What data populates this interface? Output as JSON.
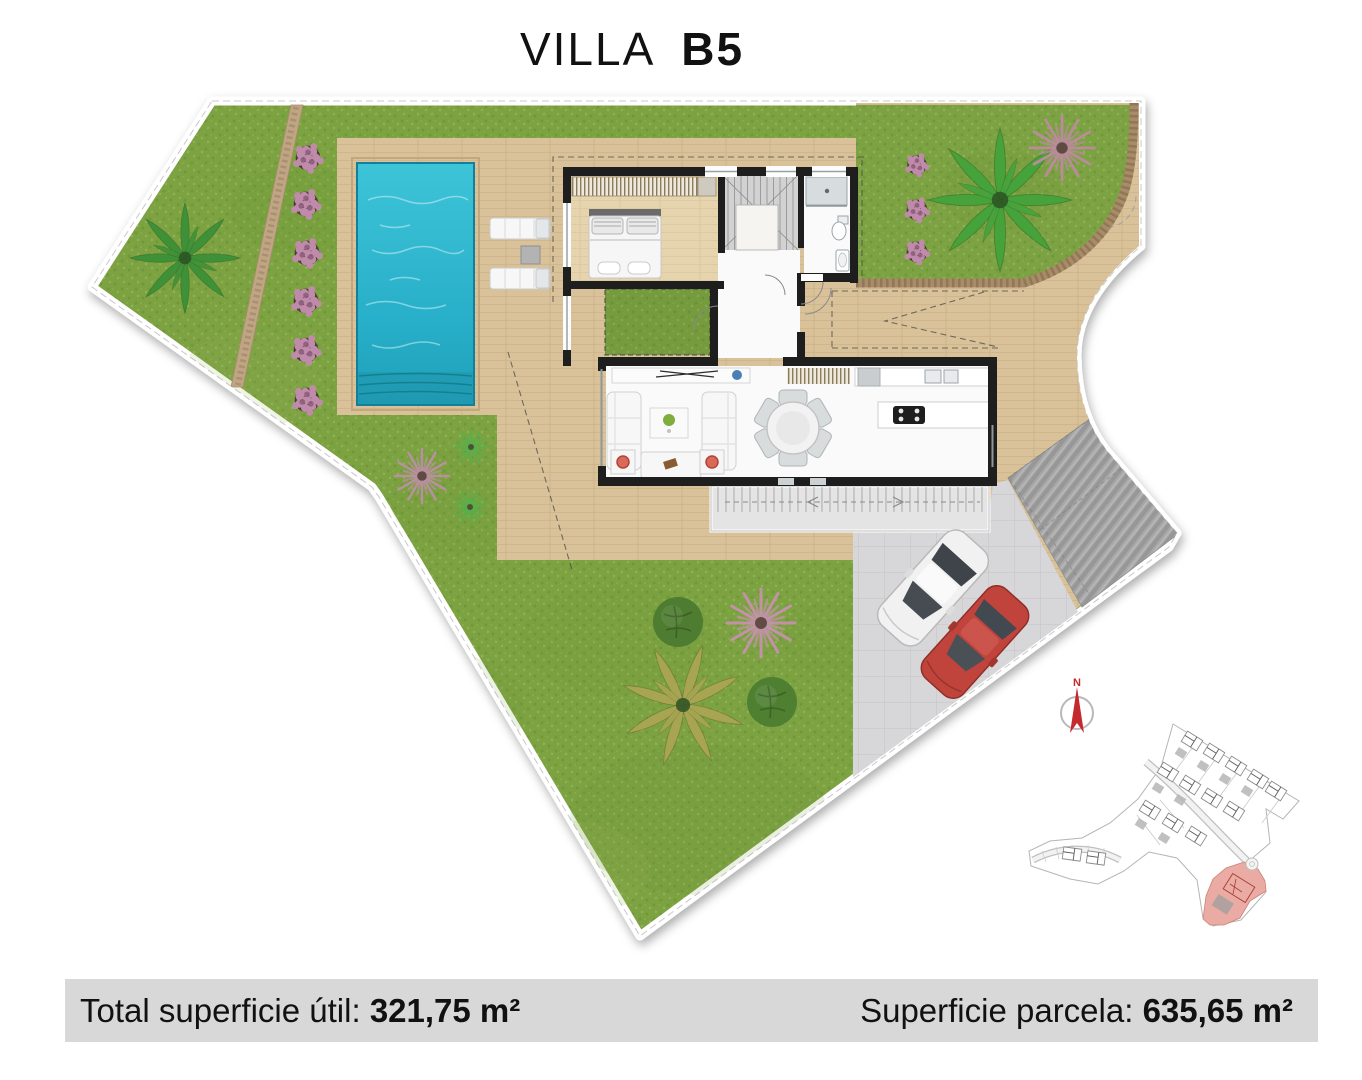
{
  "title": {
    "name": "VILLA",
    "unit": "B5"
  },
  "footer": {
    "left_label": "Total superficie útil: ",
    "left_value": "321,75 m²",
    "right_label": "Superficie parcela: ",
    "right_value": "635,65 m²"
  },
  "compass": {
    "label": "N"
  },
  "colors": {
    "lawn": "#7da243",
    "wood_deck": "#d9c29a",
    "bedroom_floor": "#e6d4ae",
    "pool_water": "#2fb9d2",
    "wall": "#1e1e1e",
    "terrace": "#e4e4e4",
    "driveway": "#d7d7d9",
    "ramp": "#a7a7a7",
    "hedge": "#a88c68",
    "footer_bar": "#d8d8d8",
    "compass_red": "#c4292e",
    "car_white": "#f1f1f1",
    "car_red": "#c0443c",
    "site_map_highlight": "#e9aba3"
  }
}
